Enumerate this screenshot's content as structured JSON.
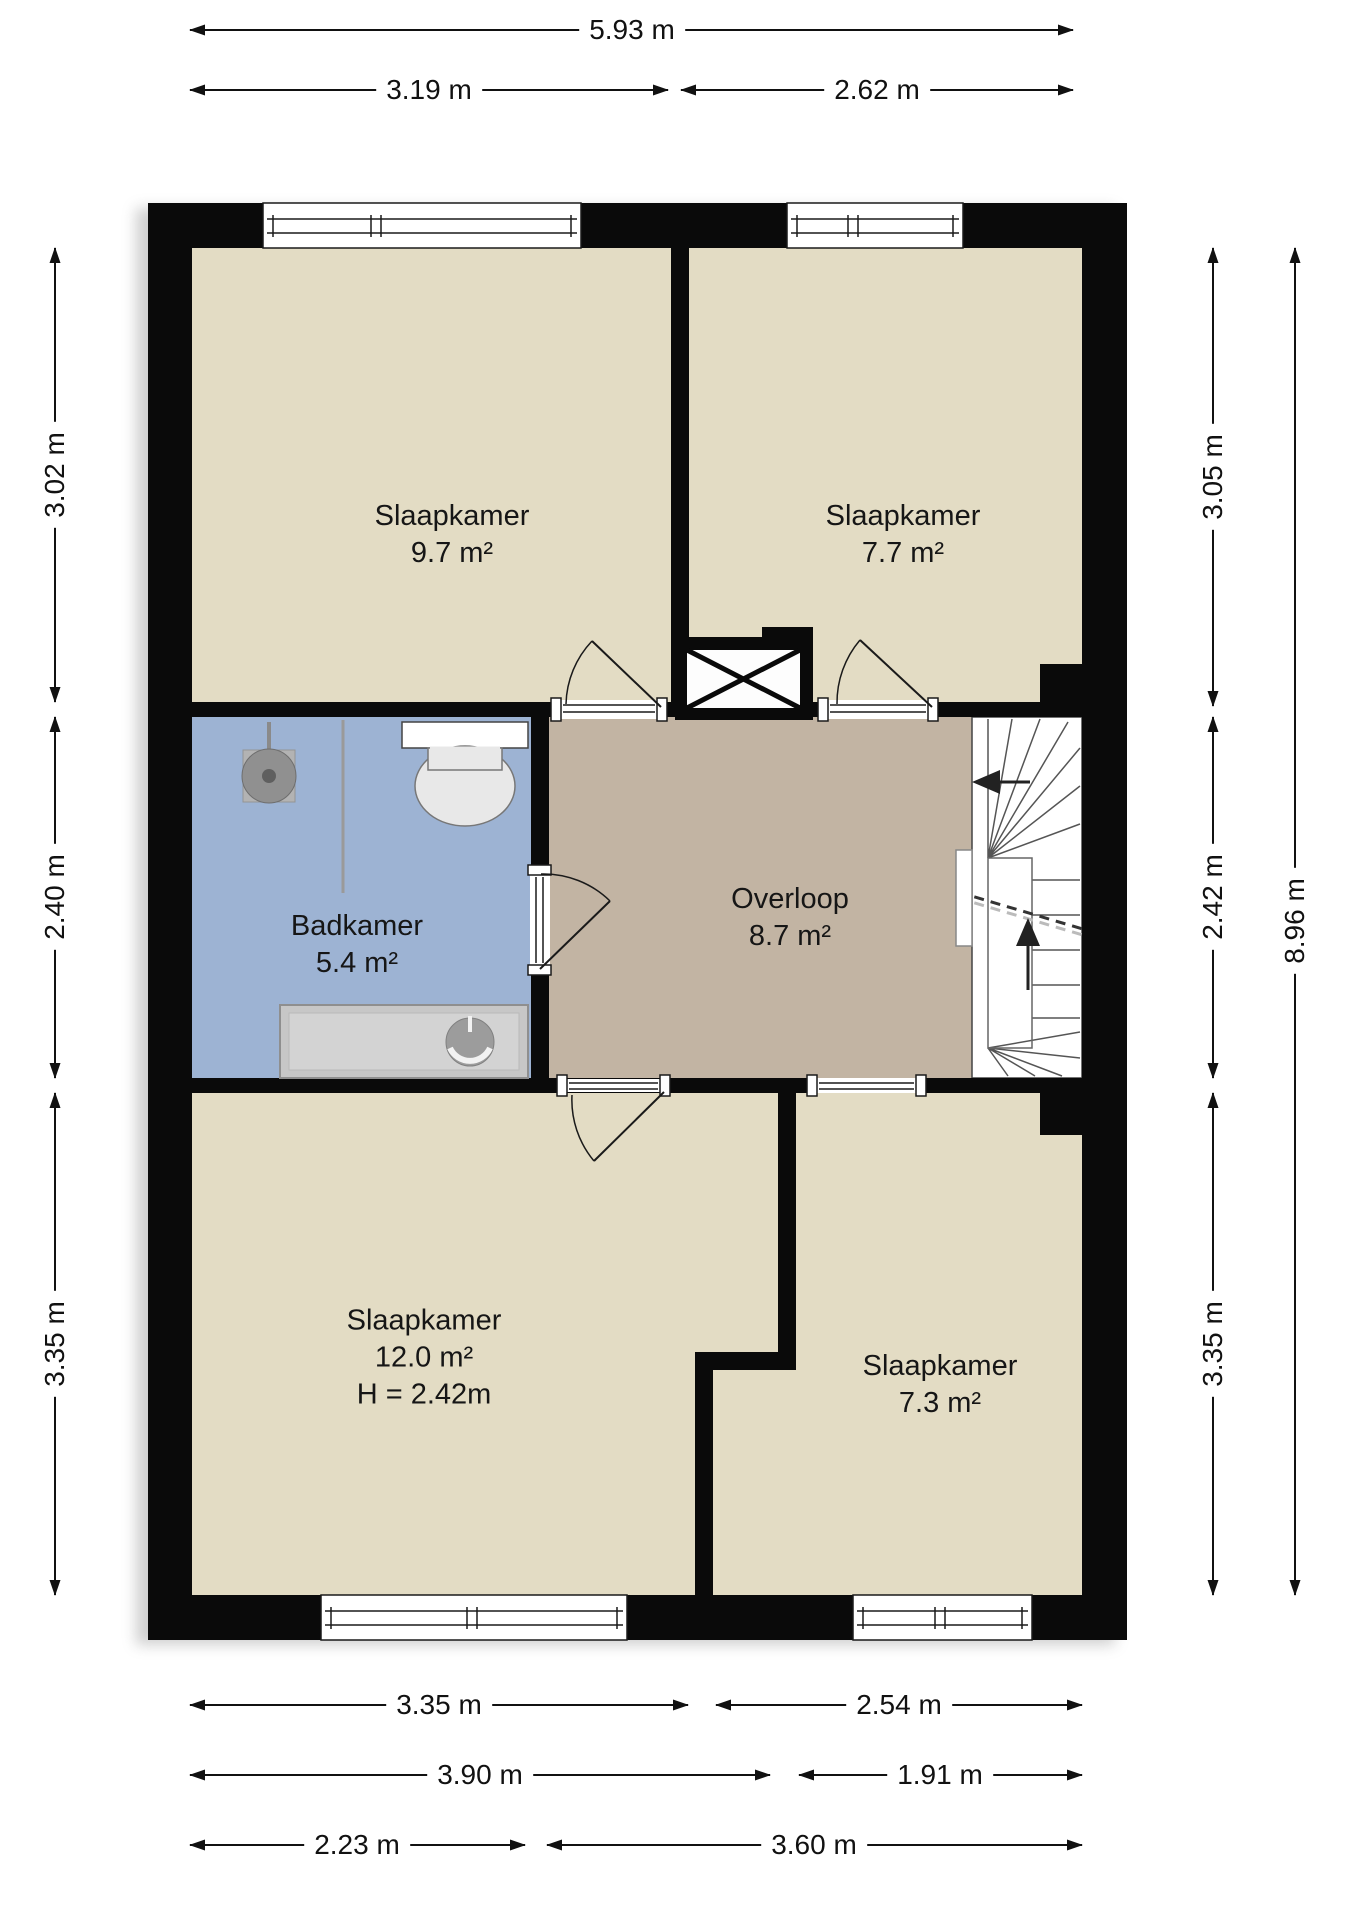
{
  "title": "Floor plan - verdieping",
  "rooms": [
    {
      "name": "Slaapkamer",
      "area": "9.7 m²"
    },
    {
      "name": "Slaapkamer",
      "area": "7.7 m²"
    },
    {
      "name": "Badkamer",
      "area": "5.4 m²"
    },
    {
      "name": "Overloop",
      "area": "8.7 m²"
    },
    {
      "name": "Slaapkamer",
      "area": "12.0 m²",
      "height": "H = 2.42m"
    },
    {
      "name": "Slaapkamer",
      "area": "7.3 m²"
    }
  ],
  "dimensions": {
    "top_total": "5.93 m",
    "top_left": "3.19 m",
    "top_right": "2.62 m",
    "left_top": "3.02 m",
    "left_middle": "2.40 m",
    "left_bottom": "3.35 m",
    "right_top": "3.05 m",
    "right_middle": "2.42 m",
    "right_bottom": "3.35 m",
    "right_total": "8.96 m",
    "bottom_row1_left": "3.35 m",
    "bottom_row1_right": "2.54 m",
    "bottom_row2_left": "3.90 m",
    "bottom_row2_right": "1.91 m",
    "bottom_row3_left": "2.23 m",
    "bottom_row3_right": "3.60 m"
  },
  "colors": {
    "wall": "#0a0a0a",
    "floor_bedroom": "#e3dcc4",
    "floor_bathroom": "#9db3d3",
    "floor_landing": "#c2b4a3",
    "stair_bg": "#ffffff",
    "dim_line": "#111111"
  }
}
